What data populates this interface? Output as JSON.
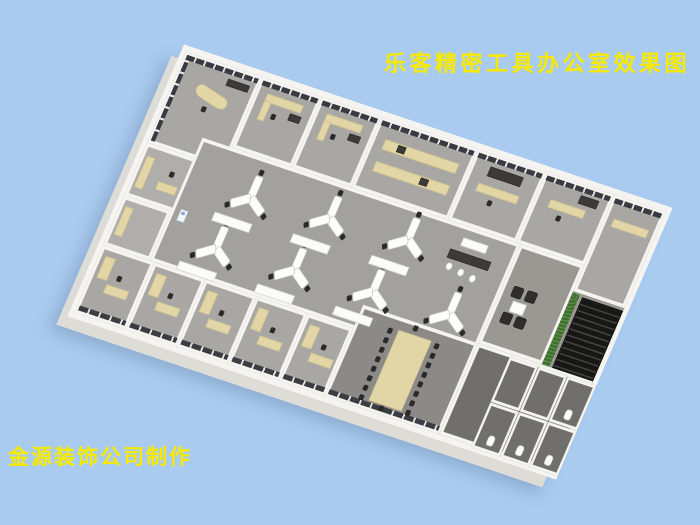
{
  "scene": {
    "title": "乐客精密工具办公室效果图",
    "credit": "金源装饰公司制作"
  },
  "colors": {
    "background": "#a9cbf0",
    "title_text": "#f7ea00",
    "wall": "#f6f4f1",
    "window": "#383c42",
    "desk": "#e2d6a6",
    "chair": "#2a2a28",
    "plant": "#3f6e30"
  }
}
